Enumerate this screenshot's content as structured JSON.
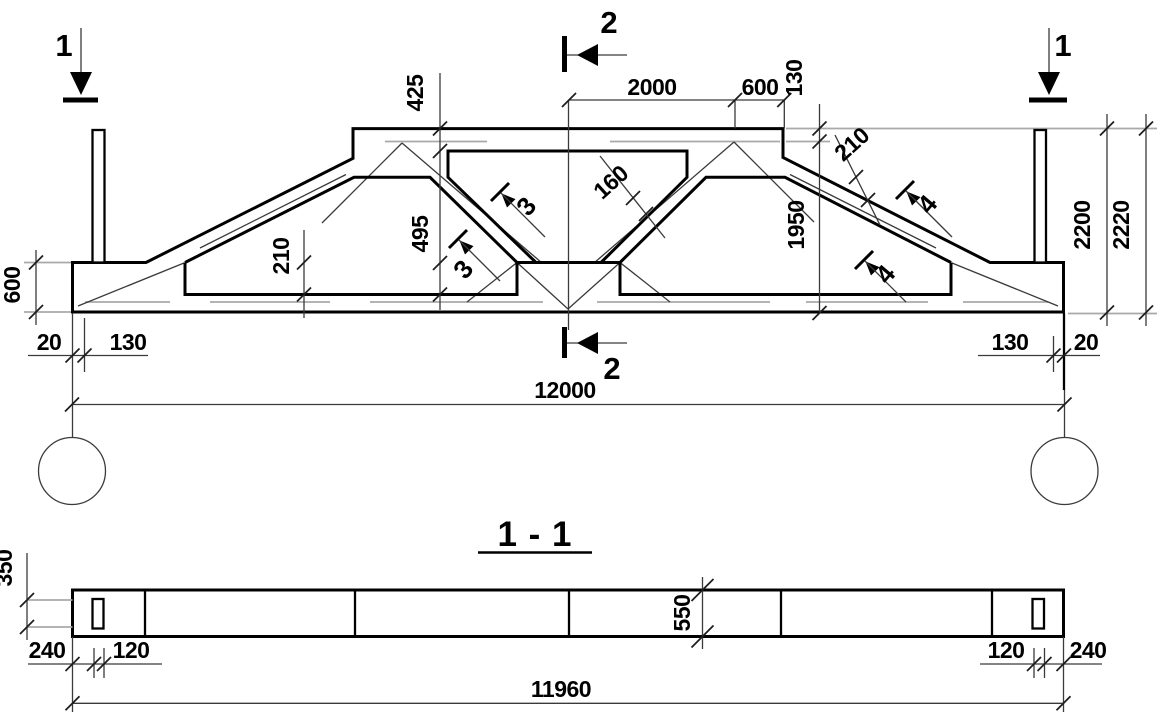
{
  "colors": {
    "line": "#000000",
    "thin_line": "#3a3a3a",
    "extension_grey": "#a9a9a9",
    "background": "#ffffff"
  },
  "elevation": {
    "section_marks": {
      "left": "1",
      "right": "1",
      "top": "2",
      "bottom": "2"
    },
    "dims": {
      "top_flat": "2000",
      "top_haunch": "600",
      "step": "130",
      "flange_425": "425",
      "strut_160": "160",
      "height_1950": "1950",
      "web_495": "495",
      "chord_210_left": "210",
      "slope_210_right": "210",
      "end_600": "600",
      "beam_2200": "2200",
      "overall_2220": "2220",
      "left_20": "20",
      "left_130": "130",
      "right_130": "130",
      "right_20": "20",
      "span": "12000"
    },
    "callouts": {
      "pos3_upper": "3",
      "pos3_lower": "3",
      "pos4_upper": "4",
      "pos4_lower": "4"
    }
  },
  "section_1_1": {
    "title": "1 - 1",
    "dims": {
      "slot_350": "350",
      "left_240": "240",
      "left_120": "120",
      "depth_550": "550",
      "right_120": "120",
      "right_240": "240",
      "length": "11960"
    }
  }
}
